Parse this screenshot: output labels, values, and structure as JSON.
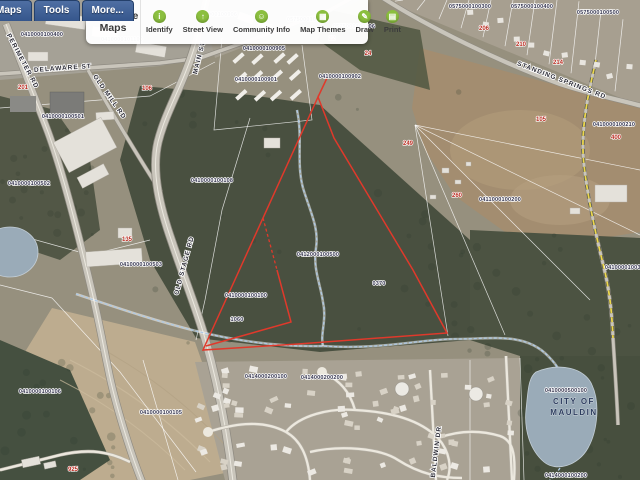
{
  "toolbar": {
    "brand": "Greenville Maps",
    "tabs": [
      {
        "label": "Maps"
      },
      {
        "label": "Tools"
      },
      {
        "label": "More..."
      }
    ],
    "buttons": [
      {
        "label": "Identify",
        "icon": "identify-icon",
        "glyph": "i"
      },
      {
        "label": "Street View",
        "icon": "street-view-icon",
        "glyph": "↑"
      },
      {
        "label": "Community Info",
        "icon": "community-info-icon",
        "glyph": "☺"
      },
      {
        "label": "Map Themes",
        "icon": "map-themes-icon",
        "glyph": "▦"
      },
      {
        "label": "Draw",
        "icon": "draw-icon",
        "glyph": "✎"
      },
      {
        "label": "Print",
        "icon": "print-icon",
        "glyph": "▤"
      }
    ]
  },
  "map": {
    "labels": [
      {
        "t": "PERIMETER RD",
        "x": 21,
        "y": 62,
        "r": 62,
        "k": "s"
      },
      {
        "t": "DELAWARE ST",
        "x": 63,
        "y": 70,
        "r": -4,
        "k": "s"
      },
      {
        "t": "MAIN ST",
        "x": 201,
        "y": 58,
        "r": -76,
        "k": "s"
      },
      {
        "t": "OLD MILL RD",
        "x": 108,
        "y": 98,
        "r": 55,
        "k": "s"
      },
      {
        "t": "OLD STAGE RD",
        "x": 186,
        "y": 266,
        "r": -75,
        "k": "s"
      },
      {
        "t": "STANDING SPRINGS RD",
        "x": 561,
        "y": 82,
        "r": 21,
        "k": "s"
      },
      {
        "t": "BALDWIN DR",
        "x": 438,
        "y": 452,
        "r": -83,
        "k": "s"
      },
      {
        "t": "CITY OF",
        "x": 574,
        "y": 404,
        "k": "c"
      },
      {
        "t": "MAULDIN",
        "x": 574,
        "y": 415,
        "k": "c"
      },
      {
        "t": "0410000100400",
        "x": 42,
        "y": 36,
        "k": "p"
      },
      {
        "t": "0410000101100",
        "x": 122,
        "y": 41,
        "k": "p"
      },
      {
        "t": "0410000100906",
        "x": 216,
        "y": 16,
        "k": "p"
      },
      {
        "t": "0410000100905",
        "x": 264,
        "y": 50,
        "k": "p"
      },
      {
        "t": "0575000100100",
        "x": 308,
        "y": 21,
        "k": "p"
      },
      {
        "t": "0575000100206",
        "x": 354,
        "y": 28,
        "k": "p"
      },
      {
        "t": "0575000100300",
        "x": 470,
        "y": 8,
        "k": "p"
      },
      {
        "t": "0575000100400",
        "x": 532,
        "y": 8,
        "k": "p"
      },
      {
        "t": "0575000100500",
        "x": 598,
        "y": 14,
        "k": "p"
      },
      {
        "t": "0410000100901",
        "x": 256,
        "y": 81,
        "k": "p"
      },
      {
        "t": "0410000100902",
        "x": 340,
        "y": 78,
        "k": "p"
      },
      {
        "t": "0410000100501",
        "x": 63,
        "y": 118,
        "k": "p"
      },
      {
        "t": "0410000100502",
        "x": 29,
        "y": 185,
        "k": "p"
      },
      {
        "t": "0410000100503",
        "x": 141,
        "y": 266,
        "k": "p"
      },
      {
        "t": "0410000100108",
        "x": 212,
        "y": 182,
        "k": "p"
      },
      {
        "t": "0412000100500",
        "x": 318,
        "y": 256,
        "k": "p"
      },
      {
        "t": "0410000100100",
        "x": 246,
        "y": 297,
        "k": "p"
      },
      {
        "t": "1060",
        "x": 237,
        "y": 321,
        "k": "p"
      },
      {
        "t": "0370",
        "x": 379,
        "y": 285,
        "k": "p"
      },
      {
        "t": "0411000100200",
        "x": 500,
        "y": 201,
        "k": "p"
      },
      {
        "t": "0410000100210",
        "x": 614,
        "y": 126,
        "k": "p"
      },
      {
        "t": "0410000100305",
        "x": 626,
        "y": 269,
        "k": "p"
      },
      {
        "t": "0410000100105",
        "x": 161,
        "y": 414,
        "k": "p"
      },
      {
        "t": "0410000100106",
        "x": 40,
        "y": 393,
        "k": "p"
      },
      {
        "t": "0414000200100",
        "x": 266,
        "y": 378,
        "k": "p"
      },
      {
        "t": "0414000200200",
        "x": 322,
        "y": 379,
        "k": "p"
      },
      {
        "t": "0410000500100",
        "x": 566,
        "y": 392,
        "k": "p"
      },
      {
        "t": "0414000100200",
        "x": 566,
        "y": 477,
        "k": "p"
      },
      {
        "t": "110",
        "x": 105,
        "y": 31,
        "k": "a"
      },
      {
        "t": "201",
        "x": 23,
        "y": 89,
        "k": "a"
      },
      {
        "t": "106",
        "x": 147,
        "y": 90,
        "k": "a"
      },
      {
        "t": "135",
        "x": 127,
        "y": 241,
        "k": "a"
      },
      {
        "t": "925",
        "x": 73,
        "y": 471,
        "k": "a"
      },
      {
        "t": "249",
        "x": 408,
        "y": 145,
        "k": "a"
      },
      {
        "t": "260",
        "x": 457,
        "y": 197,
        "k": "a"
      },
      {
        "t": "400",
        "x": 616,
        "y": 139,
        "k": "a"
      },
      {
        "t": "22",
        "x": 332,
        "y": 40,
        "k": "a"
      },
      {
        "t": "24",
        "x": 368,
        "y": 55,
        "k": "a"
      },
      {
        "t": "206",
        "x": 484,
        "y": 30,
        "k": "a"
      },
      {
        "t": "210",
        "x": 521,
        "y": 46,
        "k": "a"
      },
      {
        "t": "214",
        "x": 558,
        "y": 64,
        "k": "a"
      },
      {
        "t": "105",
        "x": 541,
        "y": 121,
        "k": "a"
      }
    ]
  },
  "colors": {
    "tab_bg": "#35568c",
    "icon_green": "#8bbf3f",
    "parcel_red": "#e0392b",
    "stream_blue": "#aec9e4",
    "boundary_yellow": "#ecd84e",
    "water_fill": "#9aabb8",
    "label_dark": "#34344e",
    "address_red": "#b92c20",
    "city_label": "#2c3c5e"
  }
}
